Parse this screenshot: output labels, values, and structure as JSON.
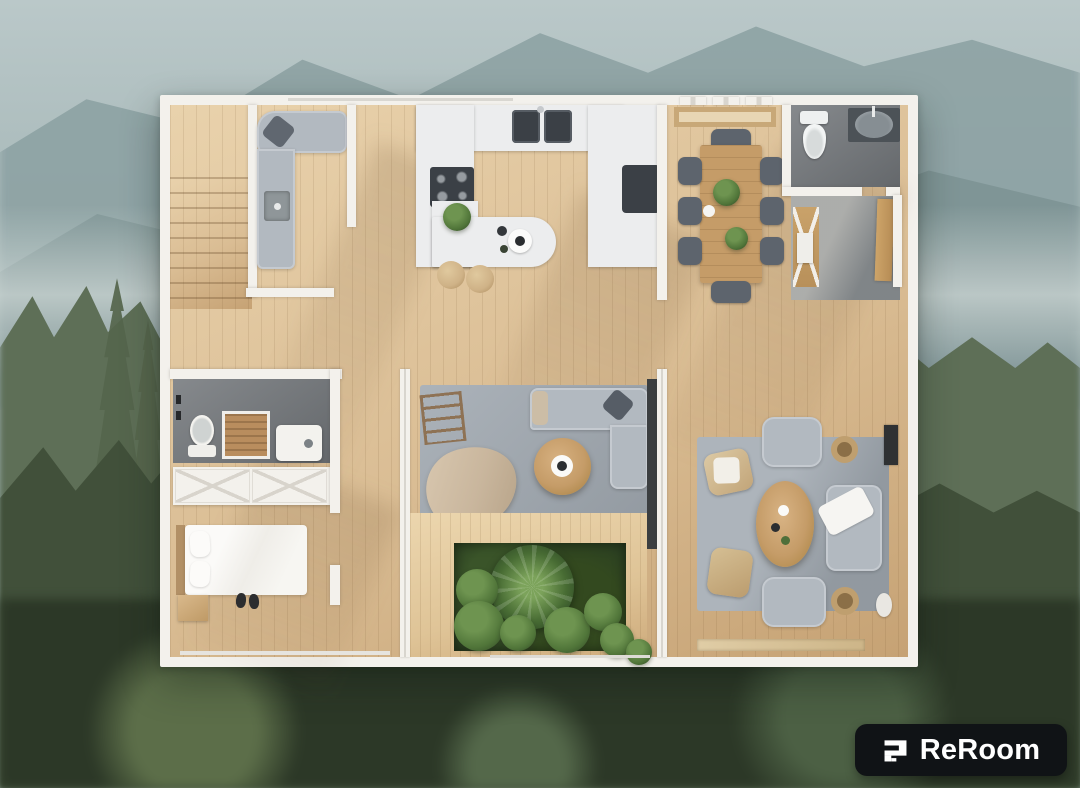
{
  "brand": {
    "logo_text": "ReRoom",
    "logo_icon": "reroom-logo-icon"
  },
  "scene": {
    "type": "3d-floor-plan-top-down-render",
    "background": "misty mountains and evergreen forest, blurred",
    "rooms": [
      {
        "name": "staircase",
        "items": [
          "stairs"
        ]
      },
      {
        "name": "den",
        "items": [
          "l-shaped-sofa",
          "throw-pillow",
          "sink-cabinet"
        ]
      },
      {
        "name": "kitchen",
        "items": [
          "u-shaped-counter",
          "double-sink",
          "cooktop",
          "oven",
          "island-counter",
          "potted-plant",
          "coffee-tray",
          "bar-stool",
          "bar-stool"
        ]
      },
      {
        "name": "dining-room",
        "items": [
          "clerestory-windows",
          "wood-pergola",
          "dining-table",
          "dining-chair-x8",
          "potted-plant",
          "potted-plant",
          "cup"
        ]
      },
      {
        "name": "bathroom",
        "items": [
          "toilet",
          "vanity-sink"
        ]
      },
      {
        "name": "entryway",
        "items": [
          "x-brace-shelf",
          "open-wood-door",
          "tile-floor"
        ]
      },
      {
        "name": "ensuite-bathroom",
        "items": [
          "mirror",
          "wood-vanity",
          "sink-with-towels",
          "wall-fixtures"
        ]
      },
      {
        "name": "closet",
        "items": [
          "x-front-wardrobe"
        ]
      },
      {
        "name": "bedroom",
        "items": [
          "single-bed",
          "pillows",
          "nightstand",
          "slippers",
          "window"
        ]
      },
      {
        "name": "living-room",
        "items": [
          "area-rug",
          "corner-sofa",
          "round-coffee-table",
          "throw-blanket",
          "decor-ladder",
          "glass-walls"
        ]
      },
      {
        "name": "courtyard-garden",
        "items": [
          "wood-deck",
          "palm-plant",
          "shrubs"
        ]
      },
      {
        "name": "lounge",
        "items": [
          "area-rug",
          "loveseat",
          "white-throw",
          "armchair",
          "armchair",
          "wicker-chair",
          "wicker-chair",
          "oval-coffee-table",
          "side-table",
          "side-table",
          "wall-art",
          "doormat"
        ]
      }
    ]
  },
  "colors": {
    "wall": "#f3f1ec",
    "wall_shadow": "#d9d6cf",
    "wood": "#dabd94",
    "wood_light": "#e9d2ac",
    "wood_dark": "#c6a274",
    "deck": "#dfc497",
    "tile_dark": "#75797d",
    "tile_entry": "#8b9093",
    "rug": "#a2aab2",
    "rug_light": "#b3bac1",
    "sofa": "#b2b9c0",
    "sofa_dark": "#5d646d",
    "counter": "#ecedee",
    "appliance": "#3b4046",
    "table_wood": "#c59c68",
    "stool_wood": "#cfb287",
    "plant_dark": "#2c4122",
    "plant": "#507539",
    "plant_light": "#6e9450",
    "linen": "#f4f3ef",
    "blanket": "#c9b69d",
    "sky_top": "#bac8c9",
    "sky_mid": "#a3b5b5",
    "mountain_far": "#8da2a4",
    "mountain_near": "#7e9395",
    "forest_mid": "#5e6f57",
    "forest_near": "#41503a",
    "forest_dark": "#2c3827",
    "badge_bg": "#101316",
    "badge_text": "#ffffff"
  }
}
